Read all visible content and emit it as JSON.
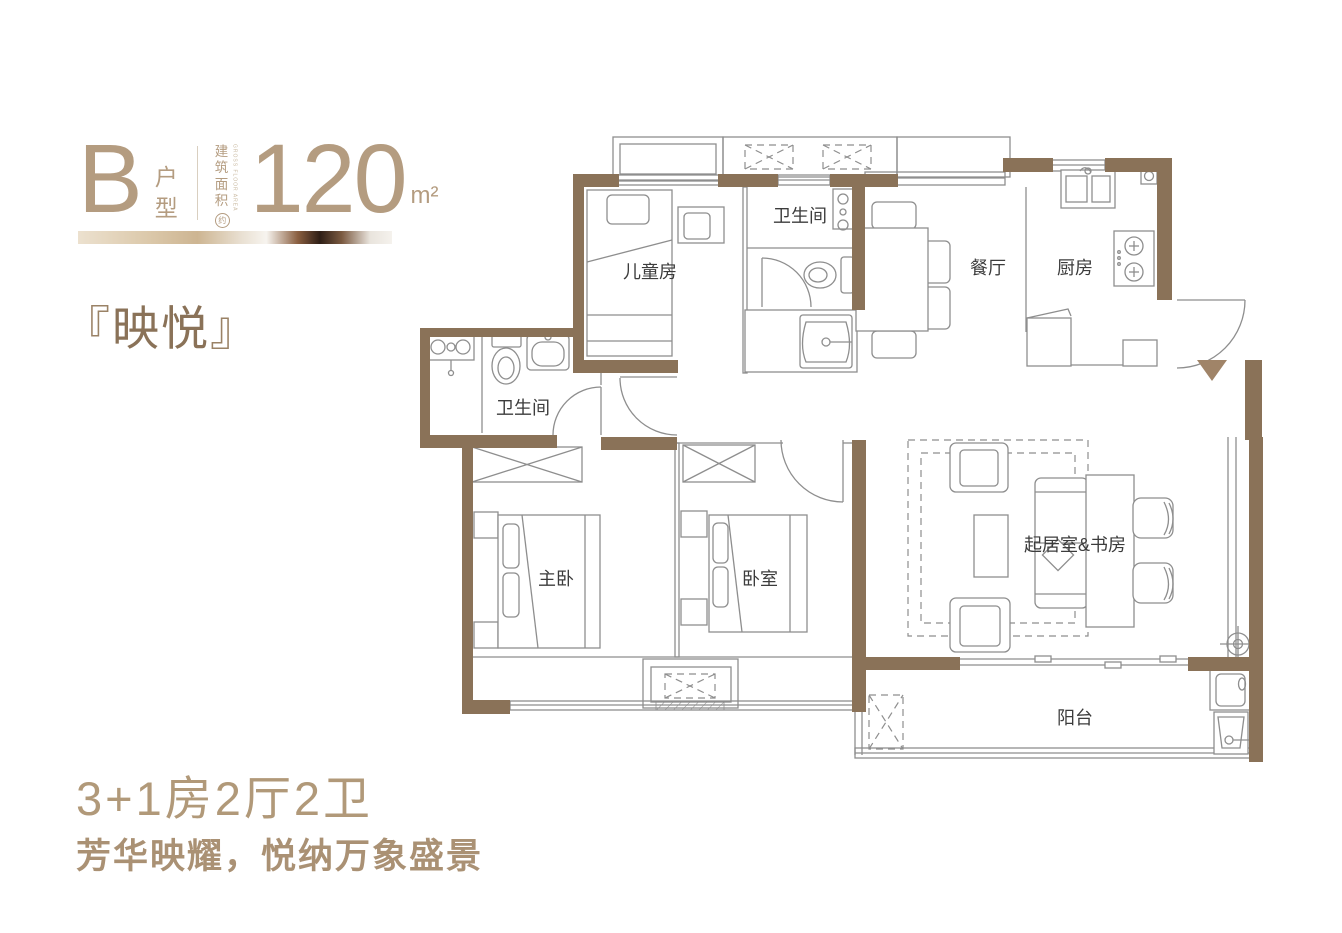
{
  "header": {
    "type_letter": "B",
    "type_label": "户型",
    "area_label": "建筑面积",
    "area_label_en": "GROSS FLOOR AREA",
    "area_approx": "约",
    "area_value": "120",
    "area_unit": "m²"
  },
  "title": {
    "bracket_open": "『",
    "name": "映悦",
    "bracket_close": "』"
  },
  "summary": {
    "layout": "3+1房2厅2卫",
    "tagline": "芳华映耀，悦纳万象盛景"
  },
  "floorplan": {
    "entrance_marker": "entry-arrow",
    "rooms": [
      {
        "id": "kids-room",
        "label": "儿童房"
      },
      {
        "id": "bathroom-top",
        "label": "卫生间"
      },
      {
        "id": "dining-room",
        "label": "餐厅"
      },
      {
        "id": "kitchen",
        "label": "厨房"
      },
      {
        "id": "bathroom-left",
        "label": "卫生间"
      },
      {
        "id": "master-bedroom",
        "label": "主卧"
      },
      {
        "id": "bedroom",
        "label": "卧室"
      },
      {
        "id": "living-study",
        "label": "起居室&书房"
      },
      {
        "id": "balcony",
        "label": "阳台"
      }
    ]
  },
  "colors": {
    "wall": "#8a7258",
    "accent": "#b49c80",
    "label_text": "#3c3c3c",
    "line": "#8e8e8e"
  }
}
